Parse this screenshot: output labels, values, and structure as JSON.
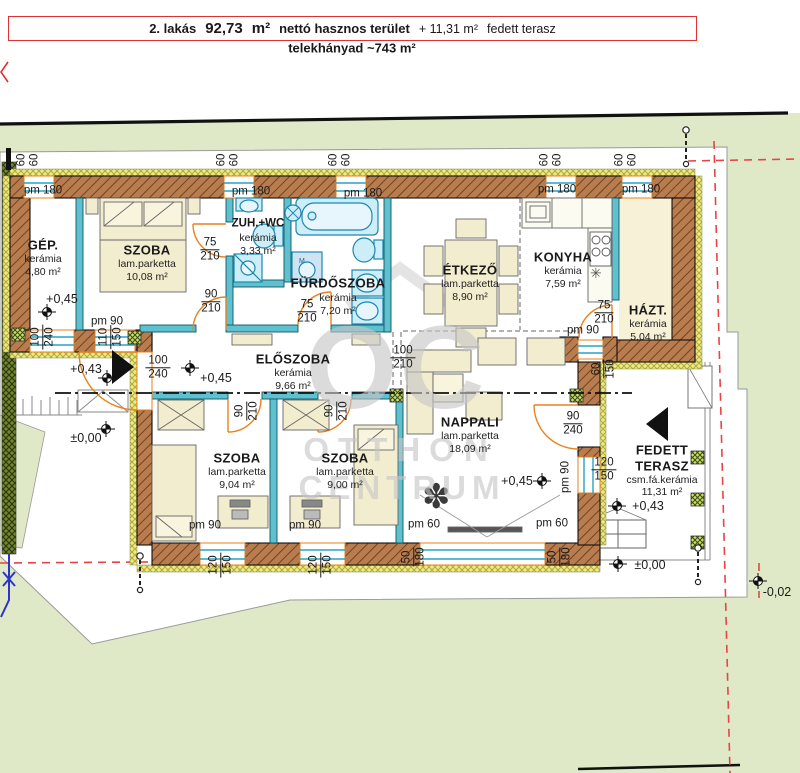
{
  "banner": {
    "apartment": "2. lakás",
    "area_value": "92,73",
    "area_unit": "m²",
    "net_label": "nettó hasznos terület",
    "terrace_area": "+ 11,31 m²",
    "terrace_label": "fedett terasz",
    "plot_share": "telekhányad ~743 m²"
  },
  "watermark": {
    "monogram": "OC",
    "line1": "OTTHON",
    "line2": "CENTRUM"
  },
  "rooms": [
    {
      "name": "GÉP.",
      "finish": "kerámia",
      "area": "4,80 m²"
    },
    {
      "name": "SZOBA",
      "finish": "lam.parketta",
      "area": "10,08 m²"
    },
    {
      "name": "ZUH.+WC",
      "finish": "kerámia",
      "area": "3,33 m²"
    },
    {
      "name": "FÜRDŐSZOBA",
      "finish": "kerámia",
      "area": "7,20 m²"
    },
    {
      "name": "ÉTKEZŐ",
      "finish": "lam.parketta",
      "area": "8,90 m²"
    },
    {
      "name": "KONYHA",
      "finish": "kerámia",
      "area": "7,59 m²"
    },
    {
      "name": "HÁZT.",
      "finish": "kerámia",
      "area": "5,04 m²"
    },
    {
      "name": "ELŐSZOBA",
      "finish": "kerámia",
      "area": "9,66 m²"
    },
    {
      "name": "SZOBA",
      "finish": "lam.parketta",
      "area": "9,04 m²"
    },
    {
      "name": "SZOBA",
      "finish": "lam.parketta",
      "area": "9,00 m²"
    },
    {
      "name": "NAPPALI",
      "finish": "lam.parketta",
      "area": "18,09 m²"
    },
    {
      "name": "FEDETT",
      "name2": "TERASZ",
      "finish": "csm.fá.kerámia",
      "area": "11,31 m²"
    }
  ],
  "levels": {
    "p045": "+0,45",
    "p043": "+0,43",
    "zero": "±0,00",
    "m002": "-0,02"
  },
  "dims": {
    "d50": "50",
    "d60": "60",
    "d75": "75",
    "d90": "90",
    "d100": "100",
    "d110": "110",
    "d120": "120",
    "d150": "150",
    "d180": "180",
    "d210": "210",
    "d240": "240",
    "pm180": "pm 180",
    "pm90": "pm 90",
    "pm60": "pm 60"
  },
  "colors": {
    "wall_brown": "#b97c4e",
    "insulation": "#eeea86",
    "partition_teal": "#5fc0cf",
    "fixture_cyan": "#cdeef8",
    "dim_orange": "#e8821e",
    "property_red": "#e64545",
    "lawn_green": "#dfe9c7"
  },
  "symbols": {
    "fridge_icon": "✳",
    "plant_icon": "✽"
  }
}
